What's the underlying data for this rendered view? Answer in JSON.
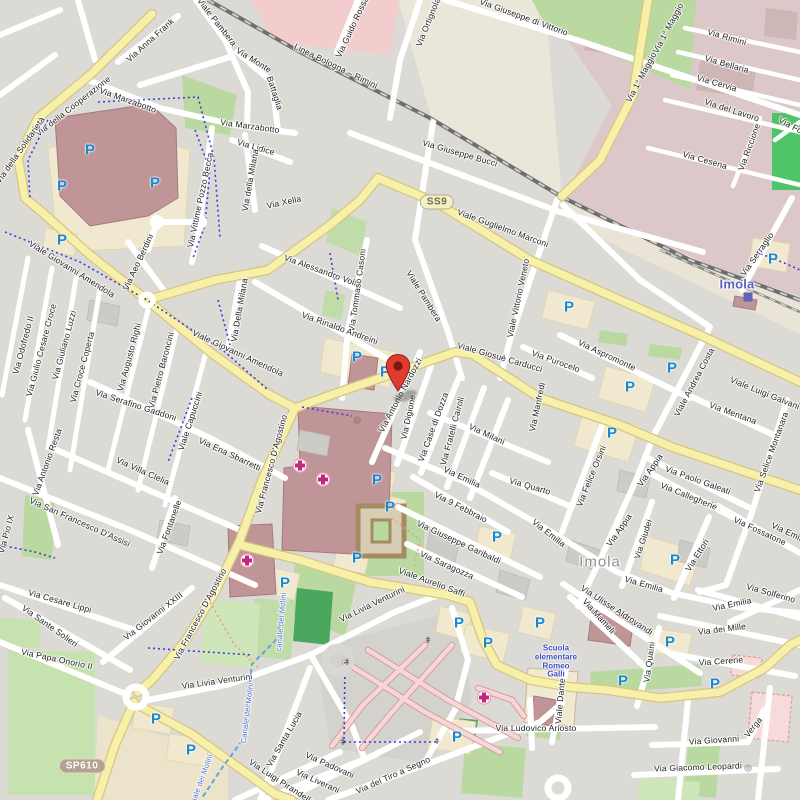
{
  "map": {
    "city": "Imola",
    "colors": {
      "base": "#dbdad5",
      "road_white": "#ffffff",
      "road_yellow": "#f6f0a8",
      "yellow_casing": "#d9c482",
      "industrial": "#dcc8c8",
      "grass": "#b9d9a1",
      "pitch": "#4fc468",
      "building_red": "#c09598",
      "parking_blue": "#1b87cd",
      "pin_red": "#e13b30",
      "hospital_pink": "#c4267c",
      "station_blue": "#5b5fc0",
      "school_blue": "#3c4ec2",
      "city_gray": "#8e8e8e",
      "canal_blue": "#4a6fd0"
    },
    "shields": [
      {
        "label": "SS9",
        "x": 437,
        "y": 202,
        "style": "ss"
      },
      {
        "label": "SP610",
        "x": 82,
        "y": 766,
        "style": "sp"
      }
    ],
    "marker": {
      "x": 398,
      "y": 398
    },
    "station": {
      "label": "Imola",
      "x": 737,
      "y": 284,
      "icon_x": 748,
      "icon_y": 297
    },
    "city_label": {
      "label": "Imola",
      "x": 600,
      "y": 562
    },
    "school": {
      "lines": [
        "Scuola",
        "elementare",
        "Romeo",
        "Galli"
      ],
      "x": 556,
      "y": 662
    },
    "railway_label": {
      "t": "Linea Bologna – Rimini",
      "x": 336,
      "y": 66,
      "r": 26
    },
    "street_labels": [
      {
        "t": "Via della Cooperazione",
        "x": 73,
        "y": 106,
        "r": -38
      },
      {
        "t": "Via della Solidarietà",
        "x": 20,
        "y": 150,
        "r": -55
      },
      {
        "t": "Via Anna Frank",
        "x": 150,
        "y": 40,
        "r": -42
      },
      {
        "t": "Via Marzabotto",
        "x": 128,
        "y": 100,
        "r": 20
      },
      {
        "t": "Via Marzabotto",
        "x": 250,
        "y": 126,
        "r": 8
      },
      {
        "t": "Via Monte",
        "x": 254,
        "y": 60,
        "r": 32
      },
      {
        "t": "Battaglia",
        "x": 275,
        "y": 93,
        "r": 72
      },
      {
        "t": "Viale Pambera",
        "x": 217,
        "y": 22,
        "r": 52
      },
      {
        "t": "Via Lidice",
        "x": 256,
        "y": 147,
        "r": 16
      },
      {
        "t": "Via della Milana",
        "x": 250,
        "y": 180,
        "r": -80
      },
      {
        "t": "Via Della Milana",
        "x": 239,
        "y": 310,
        "r": -80
      },
      {
        "t": "Via Vittime Pozzo Becca",
        "x": 200,
        "y": 200,
        "r": -78
      },
      {
        "t": "Via Guido Rossa",
        "x": 352,
        "y": 27,
        "r": -65
      },
      {
        "t": "Via Ortignola",
        "x": 428,
        "y": 22,
        "r": -68
      },
      {
        "t": "Via Giuseppe di Vittorio",
        "x": 524,
        "y": 17,
        "r": 20
      },
      {
        "t": "Via 1° Maggio",
        "x": 668,
        "y": 28,
        "r": -62
      },
      {
        "t": "Via 1° Maggio",
        "x": 641,
        "y": 77,
        "r": -62
      },
      {
        "t": "Via Rimini",
        "x": 727,
        "y": 37,
        "r": 16
      },
      {
        "t": "Via Bellaria",
        "x": 727,
        "y": 64,
        "r": 16
      },
      {
        "t": "Via Cervia",
        "x": 717,
        "y": 83,
        "r": 16
      },
      {
        "t": "Via del Lavoro",
        "x": 732,
        "y": 110,
        "r": 18
      },
      {
        "t": "Via Cesena",
        "x": 705,
        "y": 160,
        "r": 16
      },
      {
        "t": "Via Riccione",
        "x": 749,
        "y": 147,
        "r": -70
      },
      {
        "t": "Via For",
        "x": 792,
        "y": 126,
        "r": 28
      },
      {
        "t": "Via Serraglio",
        "x": 757,
        "y": 254,
        "r": -55
      },
      {
        "t": "Via Giuseppe Bucci",
        "x": 460,
        "y": 153,
        "r": 16
      },
      {
        "t": "Viale Guglielmo Marconi",
        "x": 503,
        "y": 228,
        "r": 20
      },
      {
        "t": "Via Xella",
        "x": 284,
        "y": 202,
        "r": -12
      },
      {
        "t": "Via Alessandro Volta",
        "x": 323,
        "y": 271,
        "r": 20
      },
      {
        "t": "Via Tommaso Casoni",
        "x": 357,
        "y": 290,
        "r": -82
      },
      {
        "t": "Viale Pambera",
        "x": 424,
        "y": 296,
        "r": 58
      },
      {
        "t": "Via Rinaldo Andreini",
        "x": 340,
        "y": 328,
        "r": 20
      },
      {
        "t": "Viale Vittorio Veneto",
        "x": 518,
        "y": 298,
        "r": -78
      },
      {
        "t": "Viale Giosuè Carducci",
        "x": 500,
        "y": 357,
        "r": 16
      },
      {
        "t": "Via Purocelo",
        "x": 556,
        "y": 361,
        "r": 20
      },
      {
        "t": "Via Aspromonte",
        "x": 607,
        "y": 355,
        "r": 25
      },
      {
        "t": "Via Manfredi",
        "x": 537,
        "y": 407,
        "r": -78
      },
      {
        "t": "Via Mentana",
        "x": 733,
        "y": 413,
        "r": 20
      },
      {
        "t": "Via Selice Montanara",
        "x": 771,
        "y": 452,
        "r": -70
      },
      {
        "t": "Viale Luigi Galvani",
        "x": 765,
        "y": 393,
        "r": 22
      },
      {
        "t": "Viale Andrea Costa",
        "x": 694,
        "y": 382,
        "r": -62
      },
      {
        "t": "Via Paolo Galeati",
        "x": 698,
        "y": 480,
        "r": 20
      },
      {
        "t": "Via Callegherie",
        "x": 689,
        "y": 496,
        "r": 22
      },
      {
        "t": "Via Fossatone",
        "x": 760,
        "y": 531,
        "r": 25
      },
      {
        "t": "Via Appia",
        "x": 650,
        "y": 470,
        "r": -55
      },
      {
        "t": "Via Appia",
        "x": 619,
        "y": 530,
        "r": -55
      },
      {
        "t": "Via Felice Orsini",
        "x": 591,
        "y": 476,
        "r": -68
      },
      {
        "t": "Via Quarto",
        "x": 530,
        "y": 486,
        "r": 16
      },
      {
        "t": "Via Emilia",
        "x": 462,
        "y": 477,
        "r": 25
      },
      {
        "t": "Via Emilia",
        "x": 549,
        "y": 533,
        "r": 38
      },
      {
        "t": "Via Emilia",
        "x": 644,
        "y": 584,
        "r": 16
      },
      {
        "t": "Via Emilia",
        "x": 732,
        "y": 604,
        "r": -12
      },
      {
        "t": "Via Emilia",
        "x": 790,
        "y": 533,
        "r": 25
      },
      {
        "t": "Via Milani",
        "x": 487,
        "y": 434,
        "r": 25
      },
      {
        "t": "Via Fratelli Cairoli",
        "x": 452,
        "y": 431,
        "r": -75
      },
      {
        "t": "Via Case di Dozza",
        "x": 433,
        "y": 427,
        "r": -70
      },
      {
        "t": "Via Digione",
        "x": 408,
        "y": 417,
        "r": -78
      },
      {
        "t": "Via Antonio Nardozzi",
        "x": 400,
        "y": 395,
        "r": -62
      },
      {
        "t": "Via 9 Febbraio",
        "x": 461,
        "y": 507,
        "r": 27
      },
      {
        "t": "Via Giuseppe Garibaldi",
        "x": 459,
        "y": 542,
        "r": 25
      },
      {
        "t": "Via Saragozza",
        "x": 447,
        "y": 565,
        "r": 24
      },
      {
        "t": "Viale Aurelio Saffi",
        "x": 432,
        "y": 582,
        "r": 20
      },
      {
        "t": "Via Giudei",
        "x": 643,
        "y": 539,
        "r": -72
      },
      {
        "t": "Via Ettori",
        "x": 697,
        "y": 555,
        "r": -58
      },
      {
        "t": "Via Ulisse Aldrovandi",
        "x": 617,
        "y": 610,
        "r": 33
      },
      {
        "t": "Via Mameli",
        "x": 599,
        "y": 616,
        "r": 48
      },
      {
        "t": "Via dei Mille",
        "x": 722,
        "y": 629,
        "r": -7
      },
      {
        "t": "Via Cererie",
        "x": 721,
        "y": 661,
        "r": -4
      },
      {
        "t": "Via Solferino",
        "x": 771,
        "y": 593,
        "r": 16
      },
      {
        "t": "Via Quaini",
        "x": 649,
        "y": 662,
        "r": -82
      },
      {
        "t": "Viale Dante",
        "x": 560,
        "y": 701,
        "r": -85
      },
      {
        "t": "Via Ludovico Ariosto",
        "x": 536,
        "y": 728,
        "r": 0
      },
      {
        "t": "Via Giovanni",
        "x": 714,
        "y": 740,
        "r": -4
      },
      {
        "t": "Verga",
        "x": 753,
        "y": 727,
        "r": -52
      },
      {
        "t": "Via Giacomo Leopardi",
        "x": 698,
        "y": 767,
        "r": -2
      },
      {
        "t": "Via Odofredo II",
        "x": 23,
        "y": 345,
        "r": -75
      },
      {
        "t": "Via Giulio Cesare Croce",
        "x": 41,
        "y": 350,
        "r": -75
      },
      {
        "t": "Via Giuliano Luzzi",
        "x": 64,
        "y": 345,
        "r": -75
      },
      {
        "t": "Via Croce Coperta",
        "x": 82,
        "y": 367,
        "r": -75
      },
      {
        "t": "Via Augusto Righi",
        "x": 129,
        "y": 357,
        "r": -75
      },
      {
        "t": "Via Pietro Baroncini",
        "x": 161,
        "y": 370,
        "r": -75
      },
      {
        "t": "Via Serafino Gaddoni",
        "x": 136,
        "y": 405,
        "r": 18
      },
      {
        "t": "Viale Capuccini",
        "x": 190,
        "y": 421,
        "r": -72
      },
      {
        "t": "Via Ena Sbarretti",
        "x": 230,
        "y": 454,
        "r": 25
      },
      {
        "t": "Viale Giovanni Amendola",
        "x": 72,
        "y": 269,
        "r": 32
      },
      {
        "t": "Viale Giovanni Amendola",
        "x": 238,
        "y": 353,
        "r": 25
      },
      {
        "t": "Via Aeo Berdini",
        "x": 138,
        "y": 262,
        "r": -65
      },
      {
        "t": "Via Antonio Resta",
        "x": 47,
        "y": 462,
        "r": -70
      },
      {
        "t": "Via Villa Clelia",
        "x": 143,
        "y": 471,
        "r": 24
      },
      {
        "t": "Via Fontanelle",
        "x": 169,
        "y": 527,
        "r": -70
      },
      {
        "t": "Via San Francesco D'Assisi",
        "x": 80,
        "y": 522,
        "r": 24
      },
      {
        "t": "Via Pio IX",
        "x": 6,
        "y": 534,
        "r": -75
      },
      {
        "t": "Via Francesco D'Agostino",
        "x": 271,
        "y": 464,
        "r": -75
      },
      {
        "t": "Via Francesco D'Agostino",
        "x": 200,
        "y": 614,
        "r": -62
      },
      {
        "t": "Via Cesare Lippi",
        "x": 60,
        "y": 601,
        "r": 16
      },
      {
        "t": "Via Sante Solieri",
        "x": 50,
        "y": 626,
        "r": 35
      },
      {
        "t": "Via Papa Onorio II",
        "x": 57,
        "y": 659,
        "r": 12
      },
      {
        "t": "Via Giovanni XXIII",
        "x": 153,
        "y": 616,
        "r": -38
      },
      {
        "t": "Via Livia Venturini",
        "x": 217,
        "y": 681,
        "r": -8
      },
      {
        "t": "Via Livia Venturini",
        "x": 372,
        "y": 604,
        "r": -26
      },
      {
        "t": "Via Santa Lucia",
        "x": 284,
        "y": 739,
        "r": -60
      },
      {
        "t": "Via Padovani",
        "x": 330,
        "y": 765,
        "r": 24
      },
      {
        "t": "Via Liverani",
        "x": 318,
        "y": 781,
        "r": 24
      },
      {
        "t": "Via Luigi Pirandello",
        "x": 282,
        "y": 782,
        "r": 33
      },
      {
        "t": "Via del Tiro a Segno",
        "x": 393,
        "y": 775,
        "r": -24
      }
    ],
    "canal_labels": [
      {
        "t": "canale dei Molini",
        "x": 281,
        "y": 622,
        "r": -85
      },
      {
        "t": "Canale dei Molini",
        "x": 247,
        "y": 713,
        "r": -83
      },
      {
        "t": "Canale dei Molini",
        "x": 200,
        "y": 783,
        "r": -70
      }
    ],
    "parking_icons": [
      [
        90,
        150
      ],
      [
        62,
        186
      ],
      [
        155,
        183
      ],
      [
        62,
        240
      ],
      [
        357,
        357
      ],
      [
        385,
        372
      ],
      [
        569,
        307
      ],
      [
        773,
        259
      ],
      [
        672,
        368
      ],
      [
        630,
        387
      ],
      [
        612,
        433
      ],
      [
        675,
        560
      ],
      [
        377,
        480
      ],
      [
        390,
        507
      ],
      [
        357,
        558
      ],
      [
        285,
        583
      ],
      [
        497,
        537
      ],
      [
        459,
        623
      ],
      [
        488,
        643
      ],
      [
        457,
        737
      ],
      [
        540,
        623
      ],
      [
        670,
        642
      ],
      [
        623,
        681
      ],
      [
        715,
        684
      ],
      [
        156,
        719
      ],
      [
        191,
        750
      ]
    ],
    "hospital_icons": [
      [
        300,
        468
      ],
      [
        323,
        482
      ],
      [
        247,
        563
      ],
      [
        484,
        700
      ]
    ],
    "gate_icons": [
      [
        347,
        662
      ],
      [
        343,
        742
      ],
      [
        437,
        741
      ],
      [
        428,
        640
      ]
    ],
    "monument_icons": [
      [
        357,
        420
      ],
      [
        748,
        768
      ]
    ]
  }
}
